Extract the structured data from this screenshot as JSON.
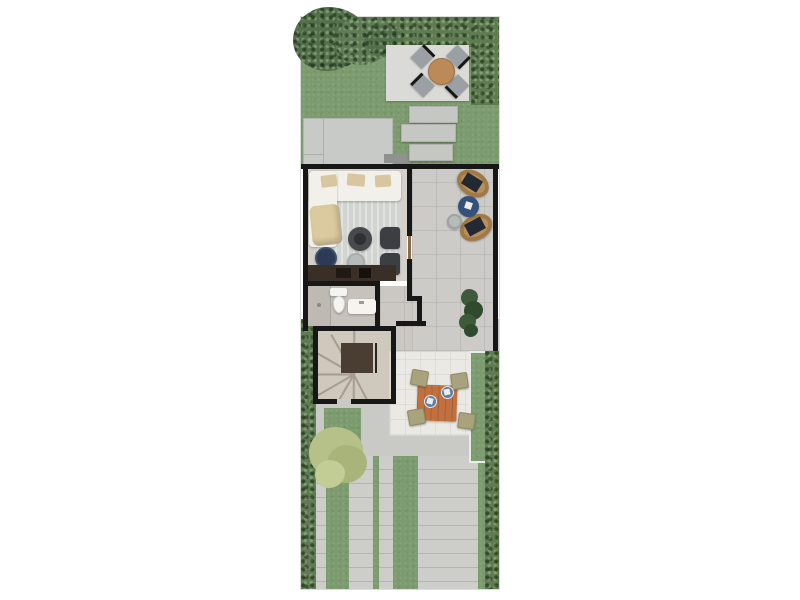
{
  "scene": {
    "type": "architectural-floor-plan",
    "view": "top-down-3d-render",
    "description": "ground floor plan of a narrow row house with back garden, living room, side terrace, bathroom, winder staircase, outdoor dining patio and front driveway",
    "visible_text": []
  },
  "palette": {
    "grass": "#7C9B6F",
    "hedge": "#5E7B52",
    "treeDark": "#52704B",
    "treeMid": "#5E7C55",
    "treeLight": "#B6C089",
    "treeLight2": "#A8B479",
    "treeLight3": "#C2CC95",
    "patioSlab": "#DADAD6",
    "deck": "#C8CAC7",
    "stone": "#C5C7C3",
    "doormat": "#8F928F",
    "wall": "#171717",
    "doorWood": "#8A6B4A",
    "livingFloor": "#D5D1CA",
    "rug": "#D1D4D1",
    "sofa": "#F2F0EB",
    "cushion": "#D8C69E",
    "lounge": "#DBCA9F",
    "coffeeTable": "#47494C",
    "coffeeTableTop": "#2E3032",
    "armchair": "#3B3F42",
    "poufNavy": "#2C3B53",
    "counter": "#3A2F26",
    "counterSink": "#211A14",
    "counterHob": "#16110D",
    "terraceFloor": "#CCCBC7",
    "rattan": "#B9905B",
    "cushionDark": "#232933",
    "poufBlue": "#34517B",
    "sideTable": "#B7BBB9",
    "plant": "#3D5A39",
    "plantDark": "#2F4A2C",
    "bathFloor": "#C7C2BB",
    "shower": "#BEB9B2",
    "fixture": "#F5F4F0",
    "stairFloor": "#CFC8BD",
    "stairBlock": "#4A3D31",
    "hallFloor": "#CBC8C3",
    "patioWhite": "#EBE9E4",
    "tableWood": "#C1713F",
    "chairOlive": "#A8A27D",
    "plateBlue": "#5E80A8",
    "napkin": "#EDEDEA",
    "concrete": "#C9CAC5",
    "paver": "#CDCDC9",
    "gardenTable": "#BC8A58",
    "chairGray": "#9AA0A4"
  },
  "areas": {
    "backyard": {
      "label": "backyard-garden",
      "items": [
        "top-hedge",
        "corner-tree",
        "lounge-patio-slab",
        "four-gray-patio-chairs",
        "round-wood-garden-table",
        "wood-deck",
        "three-stepping-stones",
        "doormat"
      ]
    },
    "living_room": {
      "label": "living-room",
      "items": [
        "l-shaped-white-sofa",
        "beige-lounge-chair",
        "area-rug",
        "round-coffee-table",
        "glass-side-table",
        "two-dark-armchairs",
        "navy-pouf",
        "kitchen-counter-with-sink-and-hob"
      ]
    },
    "terrace": {
      "label": "side-terrace",
      "items": [
        "two-rattan-chairs",
        "blue-pouf-table",
        "small-side-table",
        "potted-plant"
      ]
    },
    "bathroom": {
      "label": "bathroom",
      "items": [
        "shower",
        "toilet",
        "vanity-sink"
      ]
    },
    "staircase": {
      "label": "winder-staircase",
      "items": [
        "fanned-steps",
        "dark-center-landing"
      ]
    },
    "dining_patio": {
      "label": "outdoor-dining-patio",
      "items": [
        "square-wood-dining-table",
        "four-olive-chairs",
        "two-blue-place-settings"
      ]
    },
    "front_yard": {
      "label": "front-yard-driveway",
      "items": [
        "paver-strip-driveway",
        "grass-strips",
        "left-hedge",
        "right-hedge",
        "right-grass-strip",
        "yellow-green-tree"
      ]
    }
  }
}
